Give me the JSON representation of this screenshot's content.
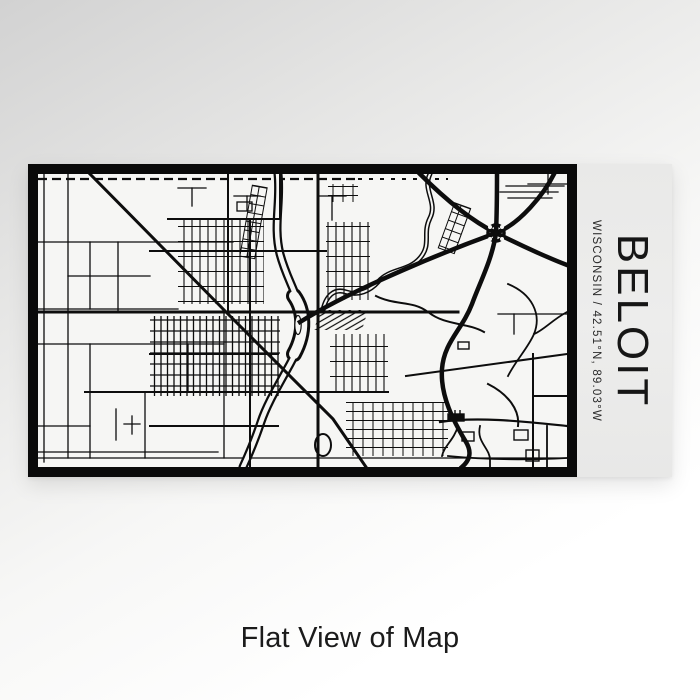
{
  "product": {
    "title": "BELOIT",
    "subtitle": "WISCONSIN / 42.51°N, 89.03°W",
    "caption": "Flat View of Map",
    "map_alt": "engraved-street-map-of-beloit"
  },
  "colors": {
    "line": "#0d0d0d",
    "frame": "#0a0a0a",
    "map_bg": "#f6f6f4",
    "label_bg": "#ebebea",
    "title_text": "#161616",
    "caption_text": "#1b1b1b"
  }
}
